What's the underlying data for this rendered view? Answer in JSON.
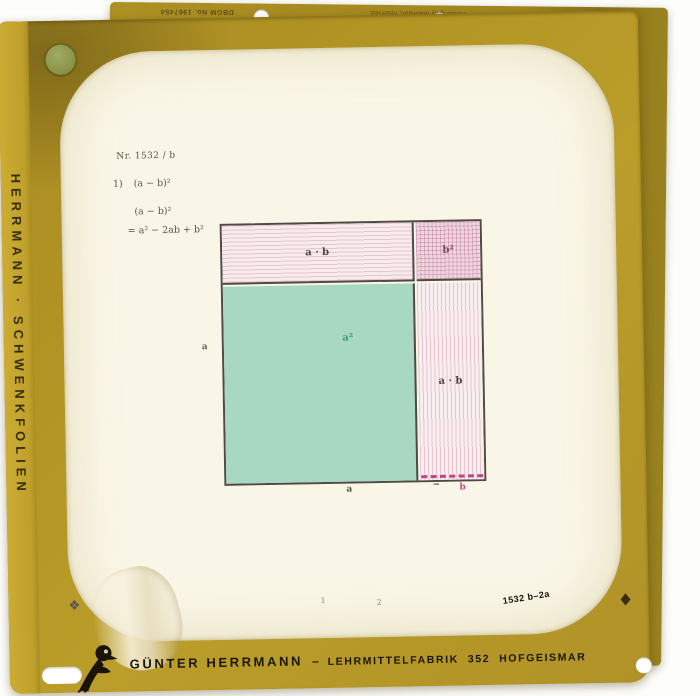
{
  "frame": {
    "side_label": "HERRMANN · SCHWENKFOLIEN",
    "top_edge": {
      "dbgm": "DBGM No. 1967454",
      "copyright_line1": "Copyright and all rights of reproduction",
      "copyright_line2": "including by television, reserved."
    },
    "stamp": "1532 b–2a",
    "footer": {
      "brand": "GÜNTER HERRMANN",
      "separator": "–",
      "factory": "LEHRMITTELFABRIK",
      "code": "352",
      "city": "HOFGEISMAR"
    },
    "marks": {
      "left_registration": "❖",
      "right_registration": "◆"
    },
    "colors": {
      "gold": "#b49626",
      "gold_dark": "#8b7318",
      "film": "#faf6e7"
    }
  },
  "sheet": {
    "number": "Nr. 1532 / b",
    "item_no": "1)",
    "expression": "(a − b)²",
    "step_lhs": "(a − b)²",
    "step_rhs": "= a² − 2ab + b²",
    "frame_number_1": "1",
    "frame_number_2": "2"
  },
  "diagram": {
    "identity": "(a − b)² = a² − 2ab + b²",
    "regions": [
      {
        "name": "top-strip",
        "label": "a · b",
        "fill": "#f6eaec"
      },
      {
        "name": "corner-square",
        "label": "b²",
        "fill": "#efd8e1"
      },
      {
        "name": "large-square",
        "label": "a²",
        "fill": "#a9d8c2"
      },
      {
        "name": "right-strip",
        "label": "a · b",
        "fill": "#f8eef0"
      }
    ],
    "axis_labels": {
      "left": "a",
      "bottom_a": "a",
      "bottom_minus": "−",
      "bottom_b": "b"
    },
    "accent_magenta": "#c2458a"
  }
}
